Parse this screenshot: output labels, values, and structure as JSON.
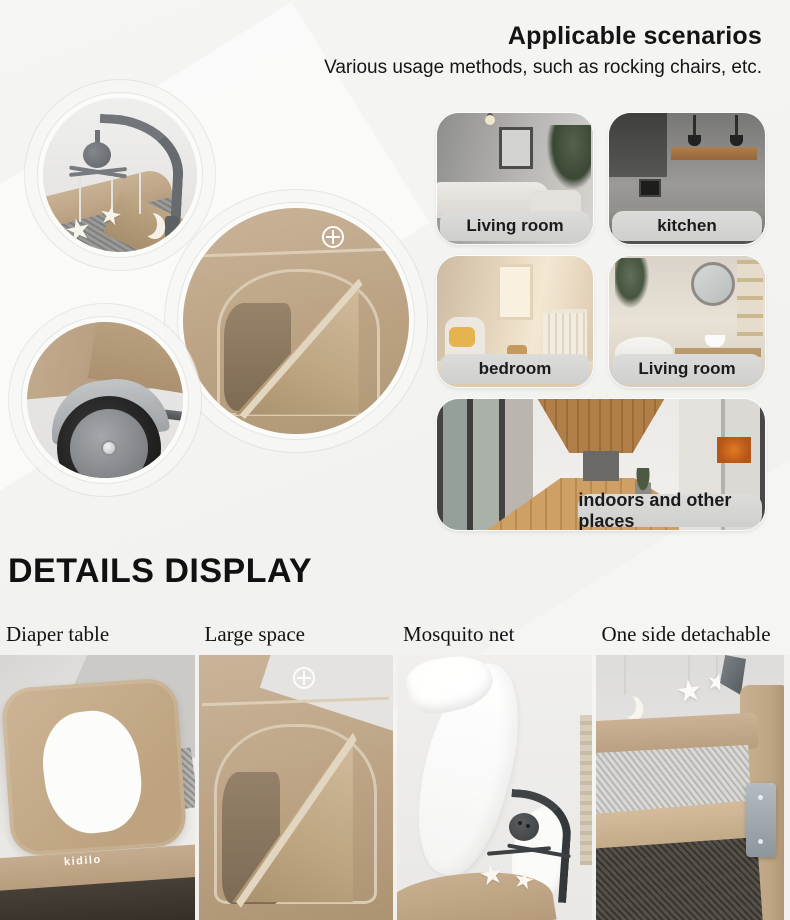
{
  "header": {
    "title": "Applicable scenarios",
    "subtitle": "Various usage methods, such as rocking chairs, etc."
  },
  "scenarios": {
    "cards": [
      {
        "label": "Living room"
      },
      {
        "label": "kitchen"
      },
      {
        "label": "bedroom"
      },
      {
        "label": "Living room"
      },
      {
        "label": "indoors and other places"
      }
    ]
  },
  "details": {
    "heading": "DETAILS DISPLAY",
    "items": [
      {
        "label": "Diaper table"
      },
      {
        "label": "Large space"
      },
      {
        "label": "Mosquito net"
      },
      {
        "label": "One side detachable"
      }
    ]
  },
  "brand": {
    "logo_text": "kidilo"
  },
  "icons": {
    "star": "★"
  },
  "colors": {
    "background": "#f3f3f1",
    "label_pill": "#d4d4d3",
    "text": "#141414",
    "fabric_tan": "#c0a88b",
    "fabric_tan_dark": "#a78e70",
    "metal_gray": "#6e7275",
    "dark_band": "#322c25"
  }
}
